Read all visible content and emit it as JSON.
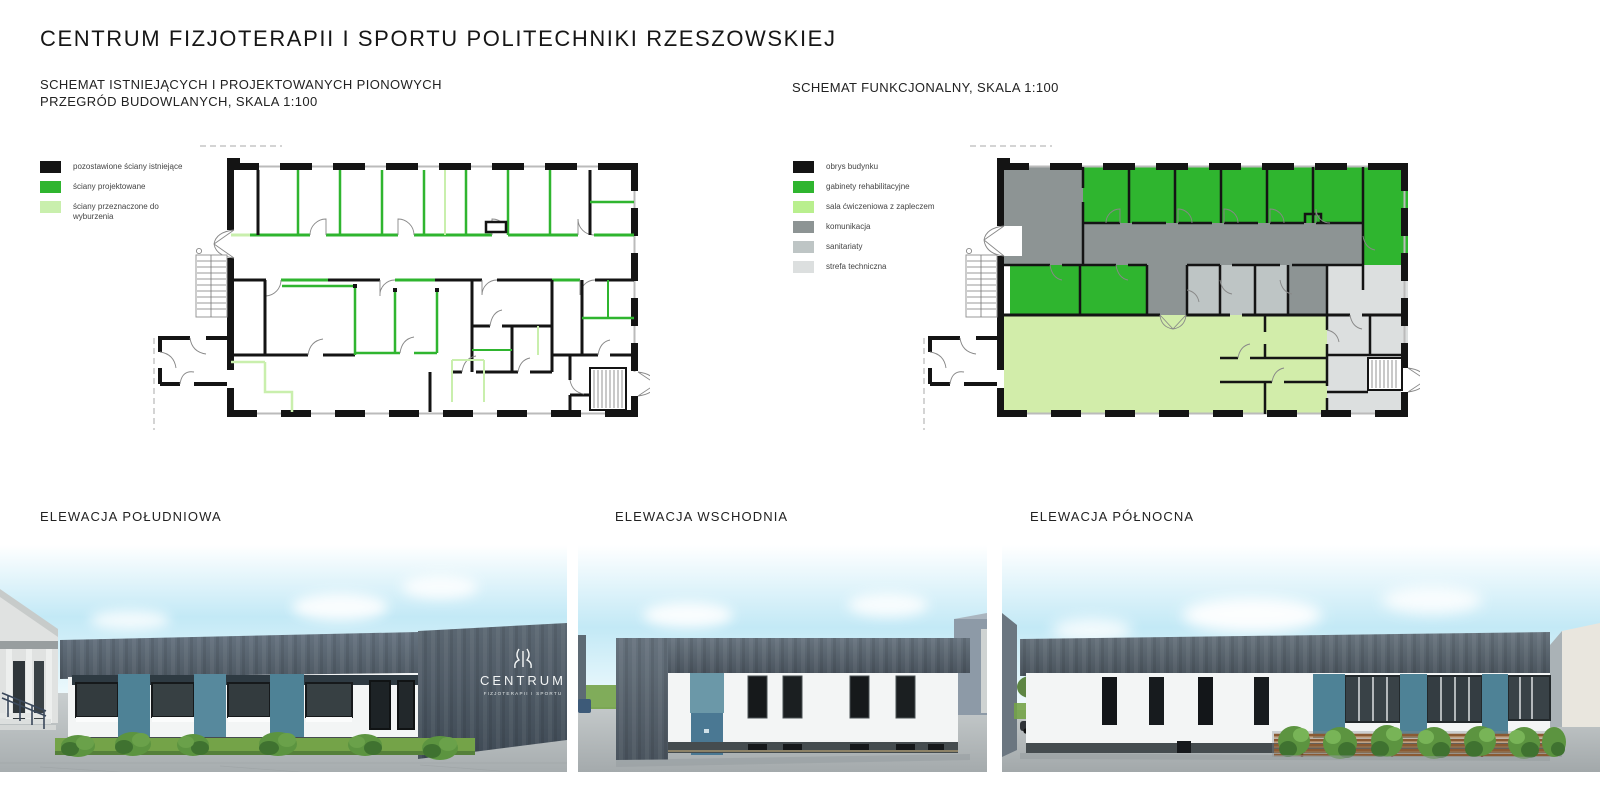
{
  "board": {
    "title": "CENTRUM FIZJOTERAPII I SPORTU POLITECHNIKI RZESZOWSKIEJ"
  },
  "plans": {
    "left": {
      "title": "SCHEMAT ISTNIEJĄCYCH I PROJEKTOWANYCH PIONOWYCH\nPRZEGRÓD BUDOWLANYCH, SKALA 1:100",
      "legend": [
        {
          "label": "pozostawione ściany istniejące",
          "color": "#141414"
        },
        {
          "label": "ściany projektowane",
          "color": "#2fb52f"
        },
        {
          "label": "ściany przeznaczone do\nwyburzenia",
          "color": "#c9efad"
        }
      ]
    },
    "right": {
      "title": "SCHEMAT FUNKCJONALNY, SKALA 1:100",
      "legend": [
        {
          "label": "obrys budynku",
          "color": "#141414"
        },
        {
          "label": "gabinety rehabilitacyjne",
          "color": "#2fb52f"
        },
        {
          "label": "sala ćwiczeniowa z zapleczem",
          "color": "#b9ef8e"
        },
        {
          "label": "komunikacja",
          "color": "#8d9494"
        },
        {
          "label": "sanitariaty",
          "color": "#bec5c5"
        },
        {
          "label": "strefa techniczna",
          "color": "#dcdfdf"
        }
      ]
    }
  },
  "elevations": [
    {
      "title": "ELEWACJA POŁUDNIOWA"
    },
    {
      "title": "ELEWACJA WSCHODNIA"
    },
    {
      "title": "ELEWACJA PÓŁNOCNA"
    }
  ],
  "logo": {
    "name": "CENTRUM",
    "subtitle": "FIZJOTERAPII I SPORTU"
  },
  "colors": {
    "wall": "#141414",
    "green": "#2fb52f",
    "light_green": "#b9ef8e",
    "pale_green": "#d2edaa",
    "demolition": "#c9efad",
    "komunikacja": "#8d9494",
    "sanitariaty": "#bec5c5",
    "strefa": "#dcdfdf",
    "parapet": "#5b6670",
    "darkwall": "#4e5a66",
    "facade": "#f3f5f5",
    "teal": "#4e8296",
    "teal_light": "#6b98a8",
    "door_blue": "#4a7893",
    "sky": "#c3e9f6",
    "grass": "#74a348",
    "bush": "#5c9440",
    "bush_dark": "#3f7230",
    "pavement": "#b6bcbd",
    "base_dark": "#454c4f",
    "fence_brown": "#8a5a33",
    "fence_light": "#b07a45"
  }
}
